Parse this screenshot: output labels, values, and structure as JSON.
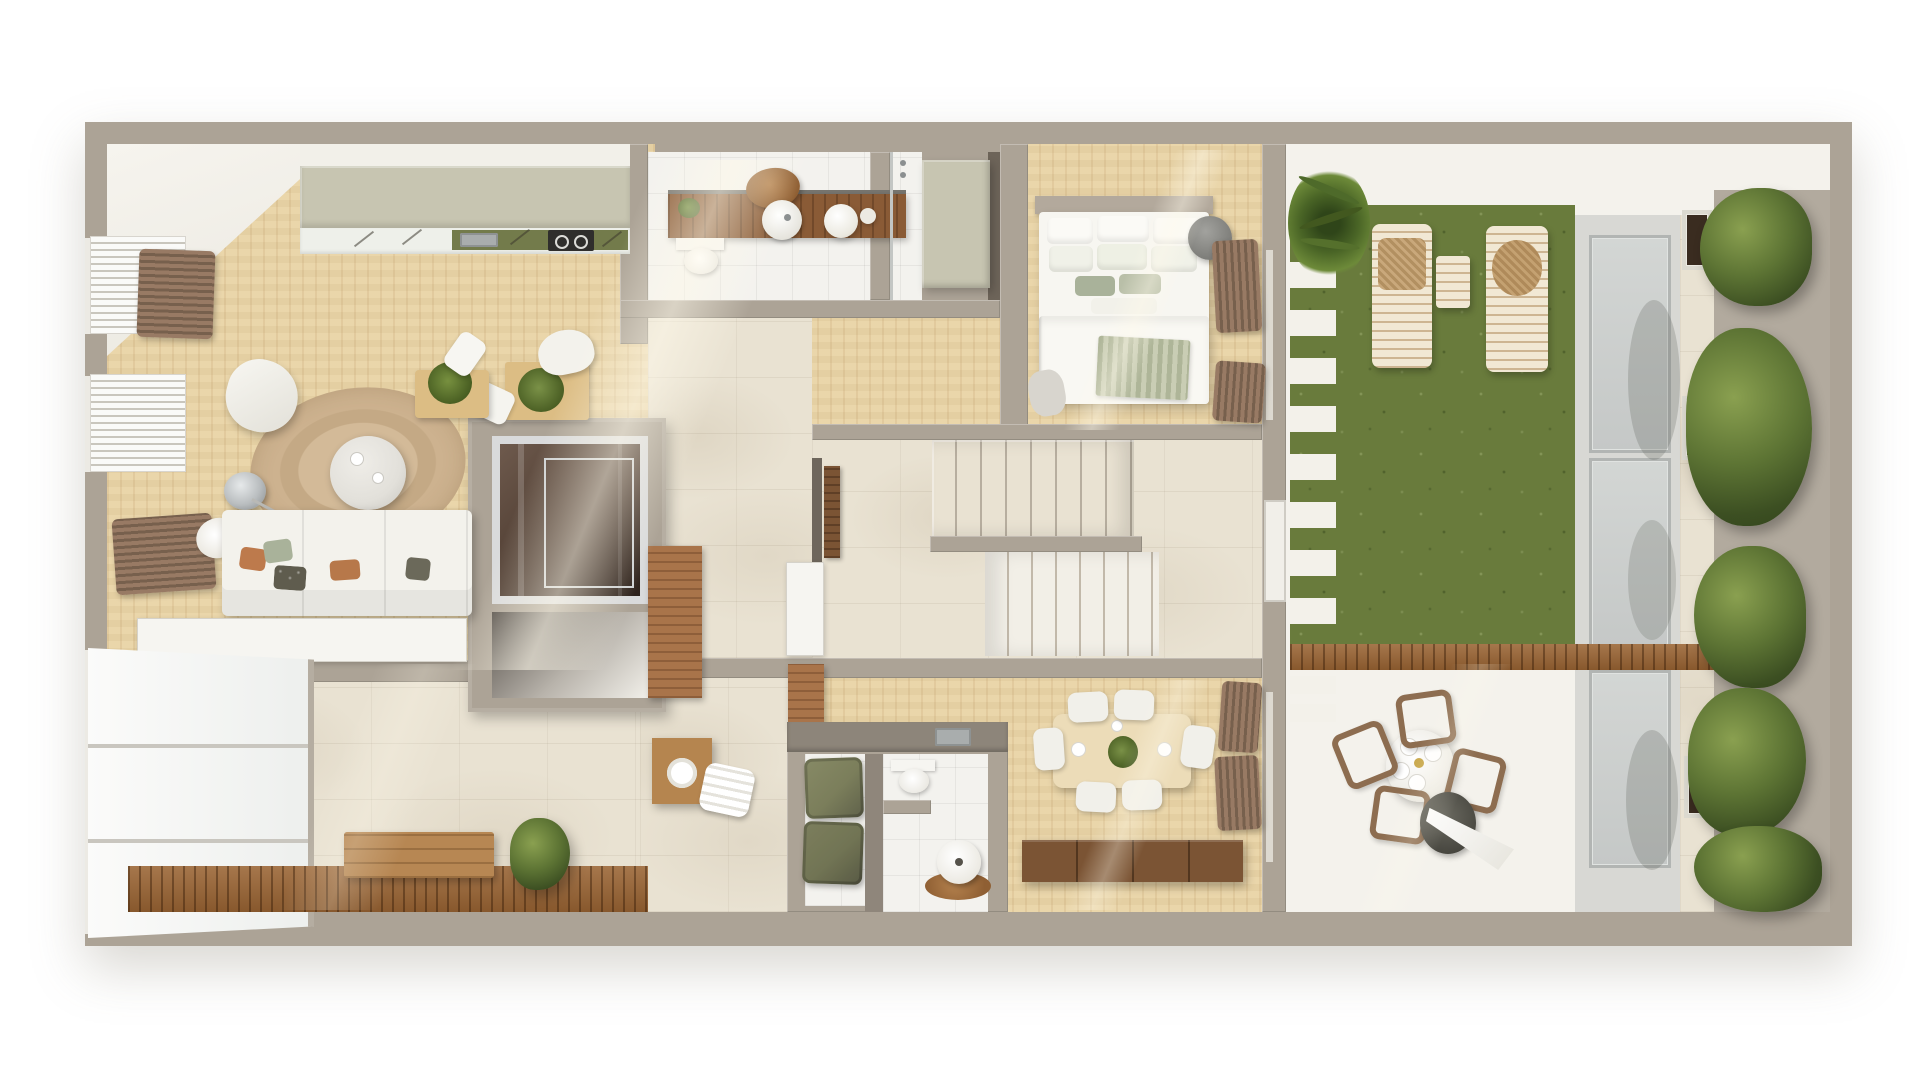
{
  "scene": {
    "type": "3d-floor-plan-top-view",
    "setting": "apartment-with-terrace-garden",
    "view": "overhead cutaway render, no visible text"
  },
  "palette": {
    "wall": "#aca396",
    "wall_light": "#c6bfb2",
    "wall_dark": "#8f867b",
    "wall_ledge": "#b2aa9e",
    "white_paint": "#f4f2ec",
    "wood": "#e9d4a6",
    "wood_hot": "#f6e9c4",
    "trav": "#e9e2d2",
    "tile": "#f3f2ee",
    "grass": "#697b3c",
    "deck": "#9a6433",
    "sage": "#c7c5b1",
    "olive_counter": "#737b4b",
    "vanity_wood": "#8a5b36",
    "walnut": "#7b5434",
    "sofa": "#f3f2ec",
    "rug": "#cdb28f",
    "pillow_rust": "#bd7a4c",
    "pillow_sage": "#a9b29a",
    "pillow_dark": "#5f5c4e",
    "curtain": "#987a64",
    "curtain_dark": "#77604d",
    "pouf_olive": "#7b7e5b",
    "marble": "#e2e0da",
    "chrome": "#b9bdbf",
    "lift_glass": "#4c3a2f",
    "skywalk": "#d8d8d4",
    "glass_panel": "#d3d6d4",
    "glass_frame": "#b2b5b3",
    "plant": "#5d7434",
    "plant_dark": "#31421b",
    "steel": "#a9adad",
    "soil": "#3a2c20"
  },
  "rooms": [
    {
      "id": "living-room",
      "floor": "wood",
      "furniture": [
        "sofa",
        "round-rug",
        "marble-coffee-table",
        "white-pouf",
        "arc-floor-lamp",
        "side-table-with-plant",
        "console-cabinet",
        "window-blinds",
        "curtains",
        "shell-decor"
      ]
    },
    {
      "id": "kitchen",
      "floor": "wood",
      "furniture": [
        "sage-cabinet-run",
        "countertop",
        "sink",
        "cooktop"
      ]
    },
    {
      "id": "bathroom",
      "floor": "white-tile",
      "furniture": [
        "wood-vanity",
        "round-basin",
        "pendant-lamps",
        "toilet",
        "wood-tray",
        "vanity-plant",
        "shower"
      ]
    },
    {
      "id": "wardrobe-nook",
      "floor": "wood",
      "furniture": [
        "closet-block"
      ]
    },
    {
      "id": "bedroom",
      "floor": "wood",
      "furniture": [
        "double-bed",
        "pillow-rows",
        "sage-throw",
        "round-ottoman",
        "curtains"
      ]
    },
    {
      "id": "stair-hall",
      "floor": "travertine",
      "furniture": [
        "upper-stair-flight",
        "lower-stair-flight",
        "wood-door",
        "terrace-door"
      ]
    },
    {
      "id": "elevator-core",
      "floor": "travertine",
      "furniture": [
        "glass-elevator",
        "open-niche",
        "wood-panel",
        "desk",
        "desk-chair",
        "desk-plant",
        "white-tray"
      ]
    },
    {
      "id": "multipurpose-room",
      "floor": "travertine",
      "furniture": [
        "wood-deck-strip",
        "wood-bench",
        "floor-plant",
        "corner-window",
        "white-console"
      ]
    },
    {
      "id": "hallway",
      "floor": "travertine",
      "furniture": [
        "wood-pedestal",
        "towel-roll",
        "white-cabinet",
        "wood-wall-cabinet"
      ]
    },
    {
      "id": "wc-laundry",
      "floor": "white-tile",
      "furniture": [
        "counter-with-sink",
        "toilet",
        "round-mirror-stand",
        "wood-mat",
        "olive-storage-poufs"
      ]
    },
    {
      "id": "dining-room",
      "floor": "wood",
      "furniture": [
        "dining-table",
        "six-white-chairs",
        "plant-centerpiece",
        "walnut-sideboard",
        "curtains"
      ]
    },
    {
      "id": "terrace-lawn",
      "floor": "grass",
      "furniture": [
        "sun-lounger",
        "sun-lounger",
        "slat-side-table",
        "stepping-planks",
        "fern-planter"
      ]
    },
    {
      "id": "terrace-walkway",
      "floor": "concrete",
      "furniture": [
        "glass-skylight-panels",
        "travertine-border",
        "hedge-planter-boxes"
      ]
    },
    {
      "id": "patio",
      "floor": "travertine",
      "furniture": [
        "round-outdoor-table",
        "four-outdoor-chairs",
        "closed-parasol",
        "wood-deck-divider"
      ]
    }
  ]
}
